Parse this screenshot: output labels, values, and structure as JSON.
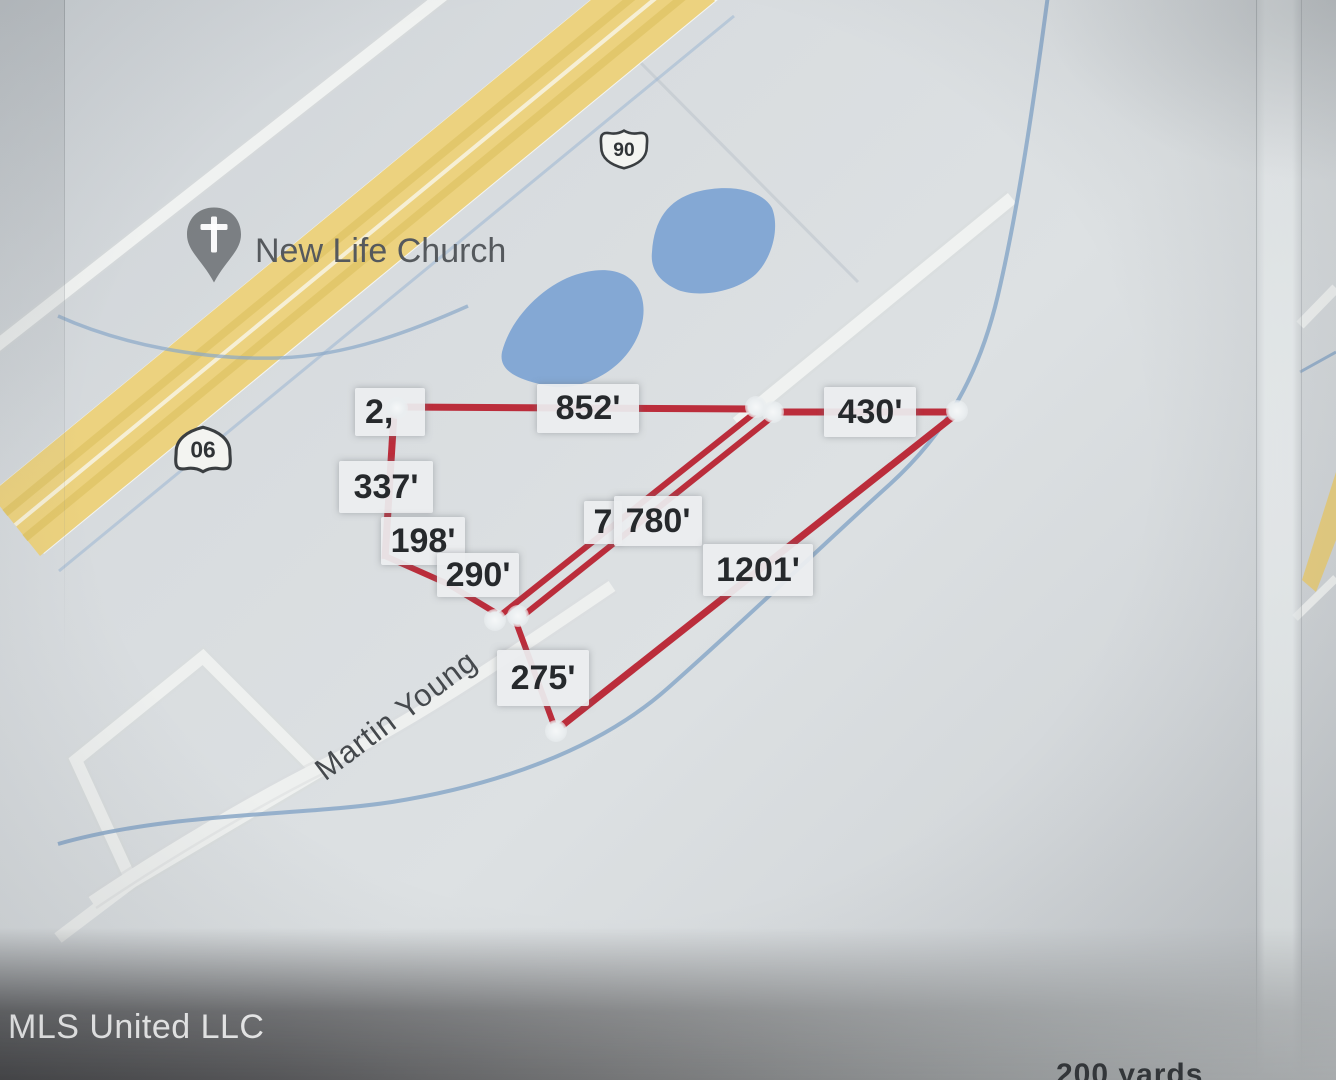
{
  "map": {
    "church_label": "New Life Church",
    "road_label": "Martin Young",
    "route_shield": "90",
    "watermark": "MLS United LLC",
    "scale_label": "200 yards",
    "measurements": {
      "partial": "2,",
      "m852": "852'",
      "m430": "430'",
      "m337": "337'",
      "m198": "198'",
      "m290": "290'",
      "m7": "7",
      "m780": "780'",
      "m1201": "1201'",
      "m275": "275'"
    },
    "colors": {
      "boundary_red": "#bb2d3b",
      "highway_yellow": "#ecd27f",
      "water_blue": "#84a8d4",
      "label_bg": "#eceef0",
      "paper": "#d8dcdf"
    }
  }
}
